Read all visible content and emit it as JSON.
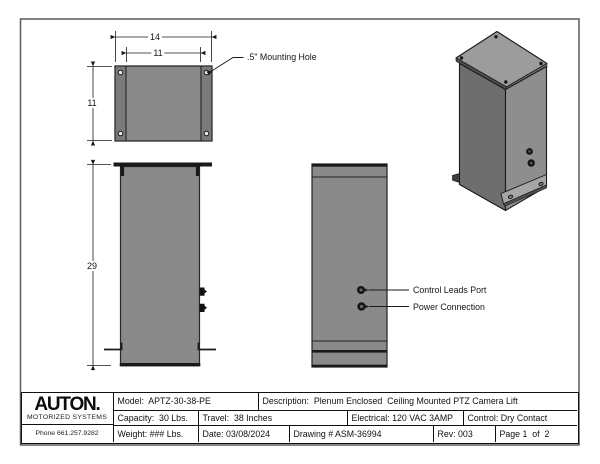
{
  "colors": {
    "body_gray": "#8a8a8a",
    "flange_gray": "#7a7a7a",
    "iso_top": "#9c9c9c",
    "iso_left": "#6e6e6e",
    "iso_right": "#8e8e8e",
    "iso_flange": "#a6a6a6",
    "edge_dark": "#4f4f4f",
    "hole_light": "#e8e8e8",
    "line": "#1a1a1a"
  },
  "dimensions": {
    "plate_width": "14",
    "plate_inner_width": "11",
    "plate_depth": "11",
    "body_height": "29"
  },
  "callouts": {
    "mounting_hole": ".5\" Mounting Hole",
    "control_leads": "Control Leads Port",
    "power_connection": "Power Connection"
  },
  "title_block": {
    "logo_text": "AUTON.",
    "logo_tagline": "MOTORIZED SYSTEMS",
    "phone": "Phone 661.257.9282",
    "model": "Model:  APTZ-30-38-PE",
    "description": "Description:  Plenum Enclosed  Ceiling Mounted PTZ Camera Lift",
    "capacity": "Capacity:  30 Lbs.",
    "travel": "Travel:  38 Inches",
    "electrical": "Electrical: 120 VAC 3AMP",
    "control": "Control: Dry Contact",
    "weight": "Weight: ### Lbs.",
    "date": "Date: 03/08/2024",
    "drawing_number": "Drawing # ASM-36994",
    "rev": "Rev: 003",
    "page": "Page 1  of  2"
  }
}
